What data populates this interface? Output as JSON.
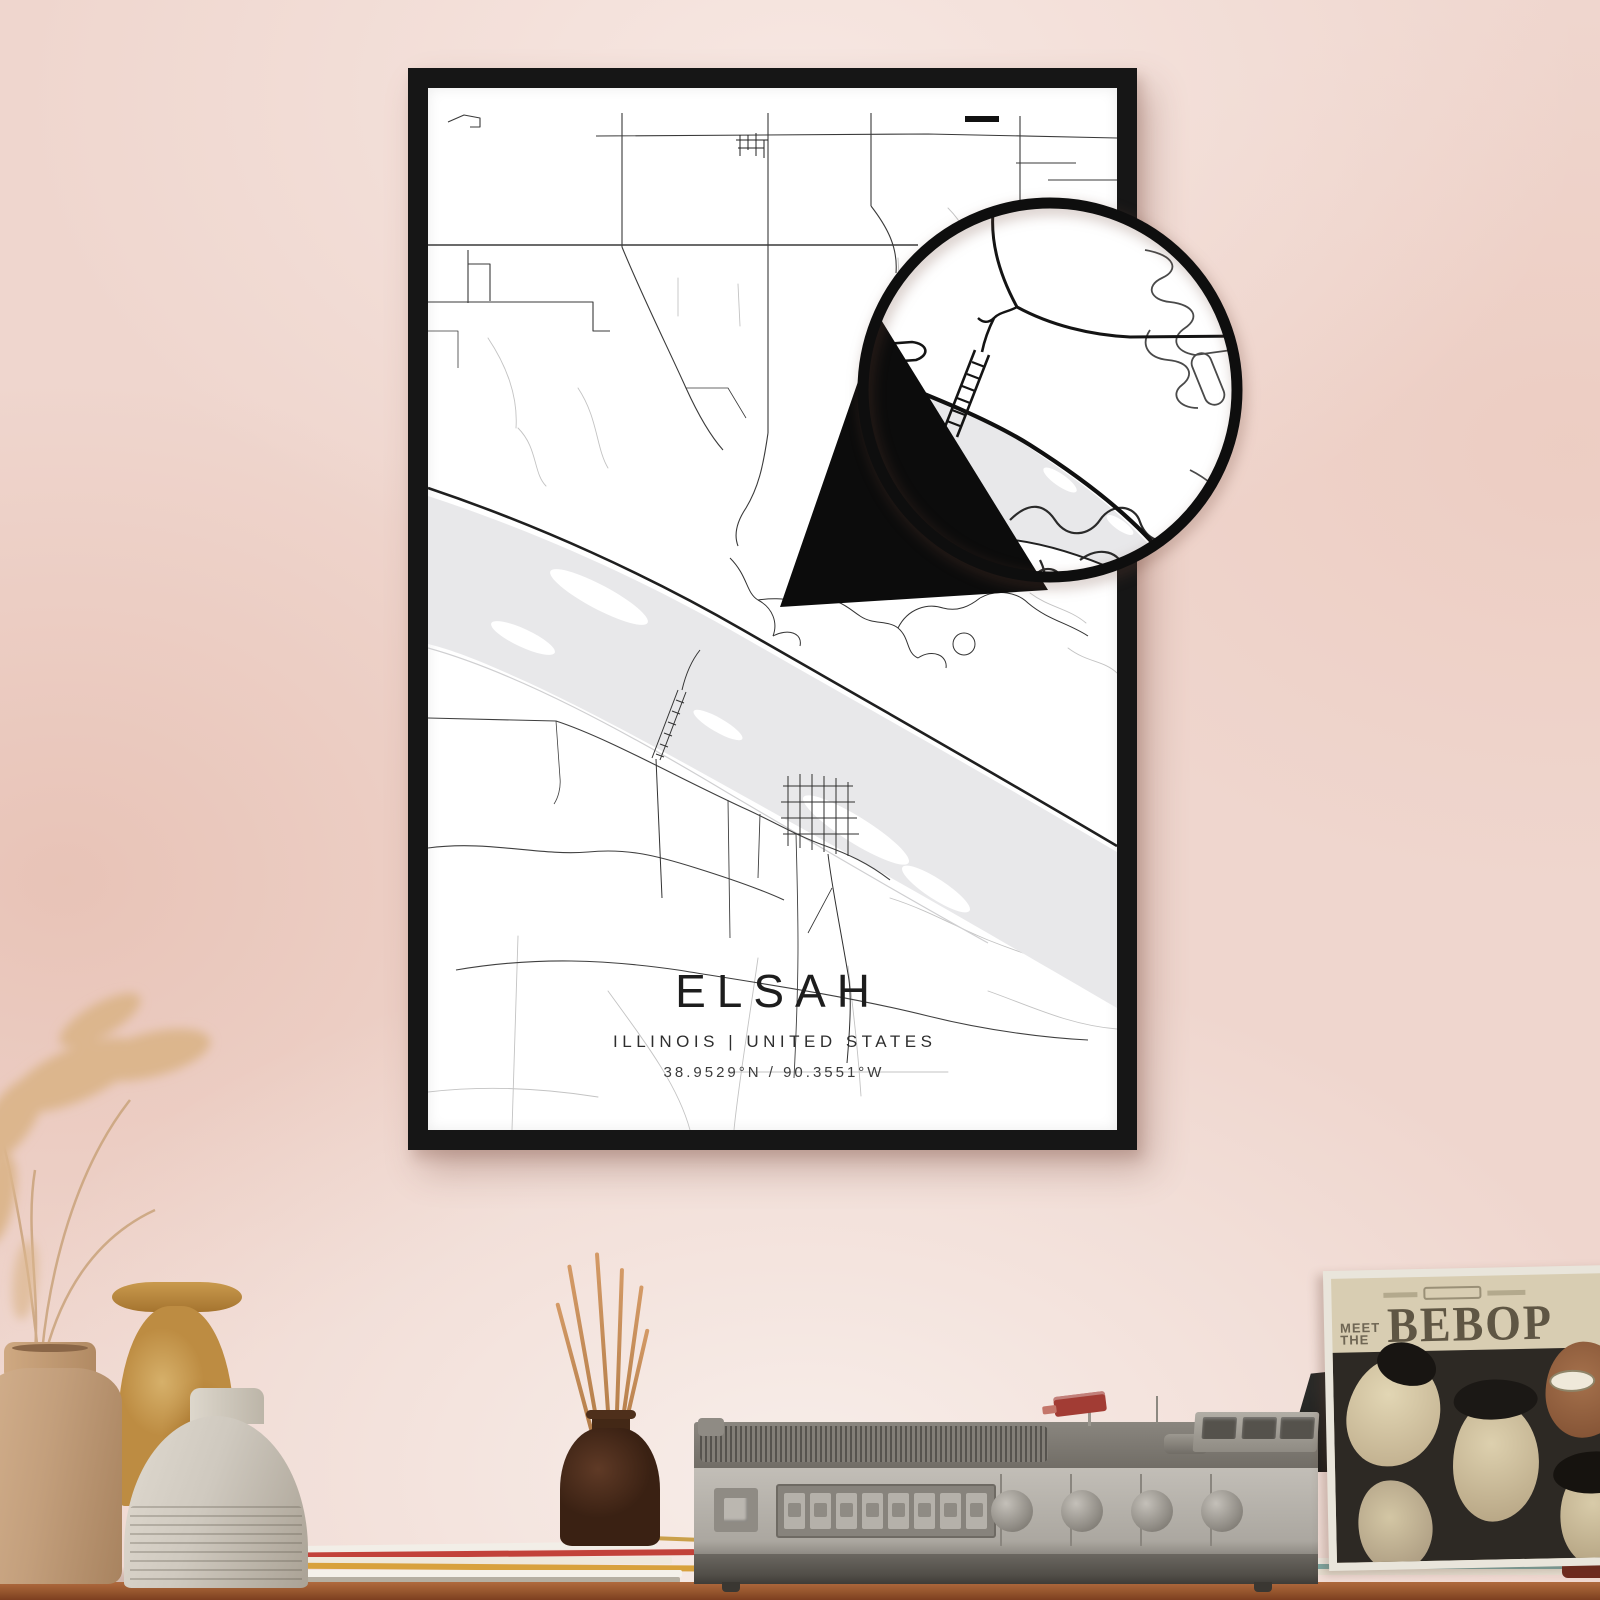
{
  "colors": {
    "wall": "#efd6ce",
    "frame": "#161616",
    "paper": "#ffffff",
    "river": "#e8e8ea",
    "road_dark": "#1f1f1f",
    "road_major": "#3a3a3a",
    "road_minor": "#b9b9b9",
    "shelf_wood": "#9c5c36",
    "album_cream": "#d8cdb2",
    "album_bg": "#2d2924",
    "stick": "#d49a66"
  },
  "poster": {
    "title": "ELSAH",
    "subtitle": "ILLINOIS | UNITED STATES",
    "coordinates": "38.9529°N / 90.3551°W"
  },
  "album": {
    "pre_title_line1": "MEET",
    "pre_title_line2": "THE",
    "title": "BEBOP"
  }
}
